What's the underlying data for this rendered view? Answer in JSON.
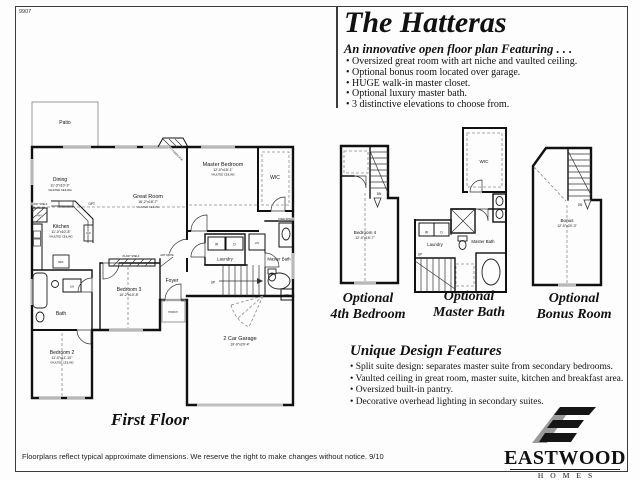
{
  "page": {
    "corner_number": "9907",
    "footer": "Floorplans reflect typical approximate dimensions. We reserve the right to make changes without notice. 9/10"
  },
  "header": {
    "title": "The Hatteras",
    "subtitle": "An innovative open floor plan Featuring . . .",
    "features": [
      "• Oversized great room with art niche and vaulted ceiling.",
      "• Optional bonus room located over garage.",
      "• HUGE walk-in master closet.",
      "• Optional luxury master bath.",
      "• 3 distinctive elevations to choose from."
    ]
  },
  "design": {
    "heading": "Unique Design Features",
    "items": [
      "• Split suite design: separates master suite from secondary bedrooms.",
      "• Vaulted ceiling in great room, master suite, kitchen and breakfast area.",
      "• Oversized built-in pantry.",
      "• Decorative overhead lighting in secondary suites."
    ]
  },
  "first_floor": {
    "caption": "First Floor",
    "patio": "Patio",
    "dining": {
      "name": "Dining",
      "dims": "11'-3\"x10'-3\"",
      "note": "VAULTED CEILING"
    },
    "great_room": {
      "name": "Great Room",
      "dims": "16'-2\"x18'-7\"",
      "note": "VAULTED CEILING"
    },
    "kitchen": {
      "name": "Kitchen",
      "dims": "11'-0\"x10'-8\"",
      "note": "VAULTED CEILING"
    },
    "master_bedroom": {
      "name": "Master Bedroom",
      "dims": "12'-0\"x15'-1\"",
      "note": "VAULTED CEILING"
    },
    "bedroom2": {
      "name": "Bedroom 2",
      "dims": "11'-0\"x11'-10\"",
      "note": "VAULTED CEILING"
    },
    "bedroom3": {
      "name": "Bedroom 3",
      "dims": "10'-2\"x10'-8\""
    },
    "garage": {
      "name": "2 Car Garage",
      "dims": "19'-0\"x20'-4\""
    },
    "bath": "Bath",
    "foyer": "Foyer",
    "laundry": "Laundry",
    "master_bath": "Master Bath",
    "wic": "WIC",
    "labels": {
      "opt": "OPT.",
      "opt_fireplace": "OPT FIREPLACE",
      "plant_shelf": "PLANT SHELF",
      "art_niche": "ART NICHE",
      "pan": "PAN",
      "ref": "REF",
      "dw": "DW",
      "lin": "LIN",
      "w": "W",
      "d": "D",
      "up": "UP",
      "porch": "PORCH",
      "knee_space": "KNEE SPACE",
      "win": "WIN"
    }
  },
  "optional_plans": {
    "bedroom4": {
      "caption1": "Optional",
      "caption2": "4th Bedroom",
      "room": "Bedroom 4",
      "dims": "12'-0\"x15'-7\"",
      "dn": "DN"
    },
    "master_bath": {
      "caption1": "Optional",
      "caption2": "Master Bath",
      "wic": "WIC",
      "laundry": "Laundry",
      "room": "Master Bath",
      "w": "W",
      "d": "D",
      "up": "UP"
    },
    "bonus": {
      "caption1": "Optional",
      "caption2": "Bonus Room",
      "room": "Bonus",
      "dims": "12'-0\"x20'-3\"",
      "dn": "DN"
    }
  },
  "logo": {
    "name": "EASTWOOD",
    "homes": "HOMES"
  }
}
